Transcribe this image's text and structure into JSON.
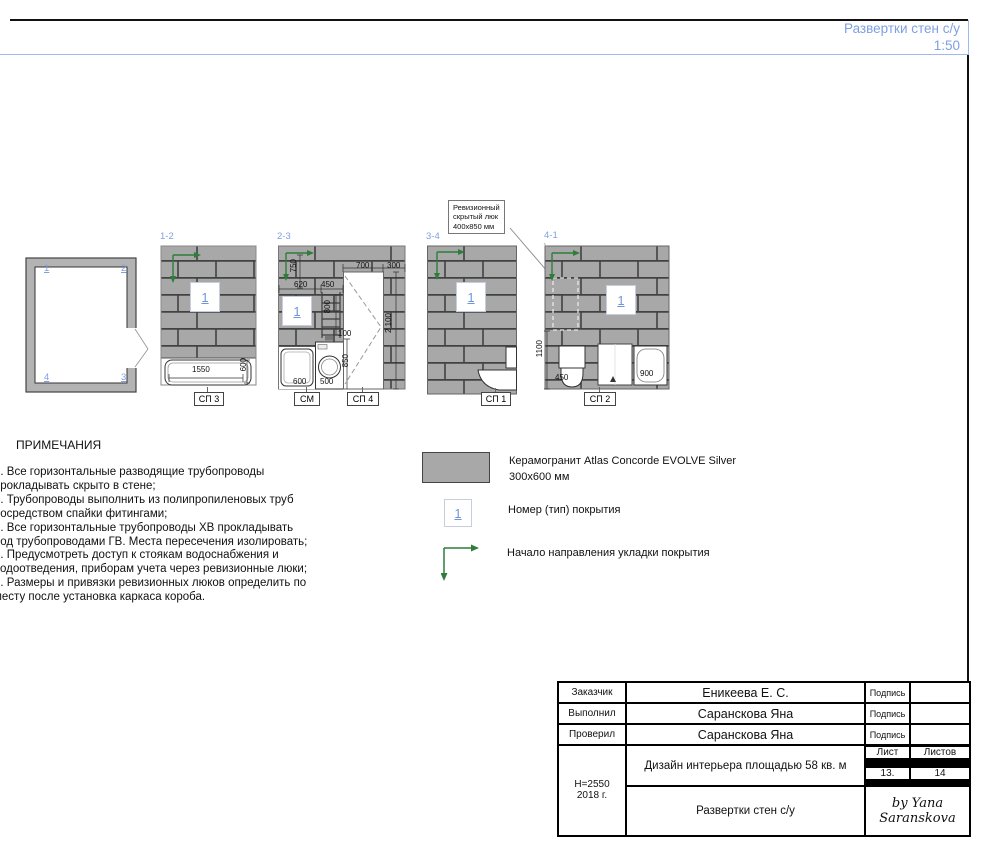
{
  "sheet": {
    "title": "Развертки стен с/у",
    "scale": "1:50"
  },
  "colors": {
    "accent_blue": "#7e9fe3",
    "tile_gray": "#a8a8a8",
    "arrow_green": "#2e7d3b"
  },
  "plan": {
    "corner_1": "1",
    "corner_2": "2",
    "corner_3": "3",
    "corner_4": "4"
  },
  "elev12": {
    "tag": "1-2",
    "marker": "1",
    "dim_width": "1550",
    "dim_depth": "600",
    "label": "СП 3"
  },
  "elev23": {
    "tag": "2-3",
    "marker": "1",
    "dim_750": "750",
    "dim_620": "620",
    "dim_450": "450",
    "dim_800": "800",
    "dim_100": "100",
    "dim_700": "700",
    "dim_300": "300",
    "dim_2100": "2 100",
    "dim_850": "850",
    "dim_600": "600",
    "dim_500": "500",
    "label_washer": "СМ",
    "label_wall": "СП 4"
  },
  "elev34": {
    "tag": "3-4",
    "marker": "1",
    "label": "СП 1",
    "callout": {
      "line1": "Ревизионный",
      "line2": "скрытый люк",
      "line3": "400х850 мм"
    }
  },
  "elev41": {
    "tag": "4-1",
    "marker": "1",
    "dim_1100": "1100",
    "dim_450": "450",
    "dim_900": "900",
    "label": "СП 2"
  },
  "notes": {
    "heading": "ПРИМЕЧАНИЯ",
    "lines": [
      "1. Все горизонтальные разводящие трубопроводы",
      "прокладывать скрыто в стене;",
      "2. Трубопроводы выполнить из полипропиленовых труб",
      "посредством спайки фитингами;",
      "3. Все горизонтальные трубопроводы ХВ прокладывать",
      "под трубопроводами ГВ. Места пересечения изолировать;",
      "4. Предусмотреть доступ к стоякам водоснабжения и",
      "водоотведения, приборам учета через ревизионные люки;",
      "5. Размеры и привязки ревизионных люков определить по",
      "месту после установка каркаса короба."
    ]
  },
  "legend": {
    "tile": {
      "line1": "Керамогранит Atlas Concorde EVOLVE Silver",
      "line2": "300х600 мм"
    },
    "marker": {
      "symbol": "1",
      "label": "Номер (тип) покрытия"
    },
    "arrow": {
      "label": "Начало направления укладки покрытия"
    }
  },
  "titleblock": {
    "rows": [
      {
        "label": "Заказчик",
        "value": "Еникеева Е. С.",
        "sign": "Подпись"
      },
      {
        "label": "Выполнил",
        "value": "Саранскова Яна",
        "sign": "Подпись"
      },
      {
        "label": "Проверил",
        "value": "Саранскова Яна",
        "sign": "Подпись"
      }
    ],
    "height_note": "H=2550",
    "year": "2018 г.",
    "project": "Дизайн интерьера площадью 58 кв. м",
    "sheet_label": "Лист",
    "sheets_label": "Листов",
    "sheet_no": "13.",
    "sheets_total": "14",
    "drawing_title": "Развертки стен с/у",
    "signature_line1": "by Yana",
    "signature_line2": "Saranskova"
  }
}
